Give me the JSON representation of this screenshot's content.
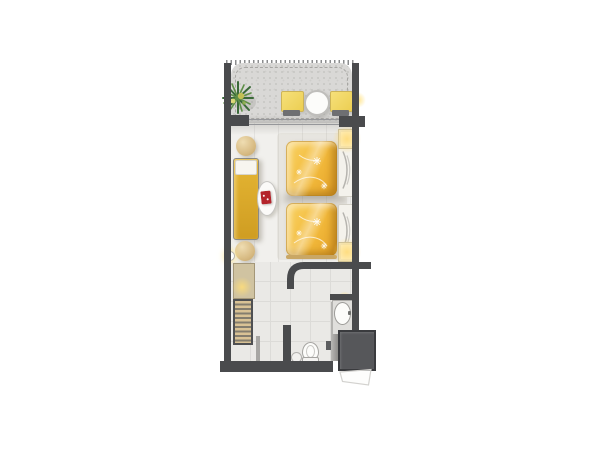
{
  "app": {
    "title": "Hotel studio guest room floor plan"
  },
  "colors": {
    "wall": "#4a4b4d",
    "balcony_floor": "#d9d8d6",
    "room_floor": "#f1f0ed",
    "bath_floor": "#eae9e6",
    "bed_gold": "#f2ba3c",
    "chaise_gold": "#cf9d22",
    "pouf_tan": "#d6b981",
    "book_red": "#b4242b",
    "shaft": "#56575a",
    "lamp_glow": "#ffde78",
    "plant_green": "#3a6a38",
    "fixture_white": "#fcfcfa"
  },
  "rooms": {
    "balcony": {
      "label": "Balcony",
      "items": [
        "potted-palm",
        "patio-chair",
        "patio-chair",
        "round-patio-table",
        "wall-light"
      ]
    },
    "bedroom": {
      "label": "Bedroom",
      "items": [
        "twin-bed",
        "twin-bed",
        "nightstand-lamp",
        "nightstand-lamp",
        "chaise-lounge",
        "ottoman",
        "ottoman",
        "oval-side-table",
        "red-book",
        "wall-light",
        "sliding-glass-door"
      ]
    },
    "entry": {
      "label": "Entry hall",
      "items": [
        "dresser-with-lamp",
        "wardrobe",
        "entry-door"
      ]
    },
    "bathroom": {
      "label": "Bathroom",
      "items": [
        "vanity-sink",
        "toilet",
        "waste-bin",
        "glass-partition",
        "towel-rail",
        "curved-wall"
      ]
    },
    "service": {
      "label": "Service shaft",
      "items": [
        "shaft-column",
        "door-swing"
      ]
    }
  }
}
